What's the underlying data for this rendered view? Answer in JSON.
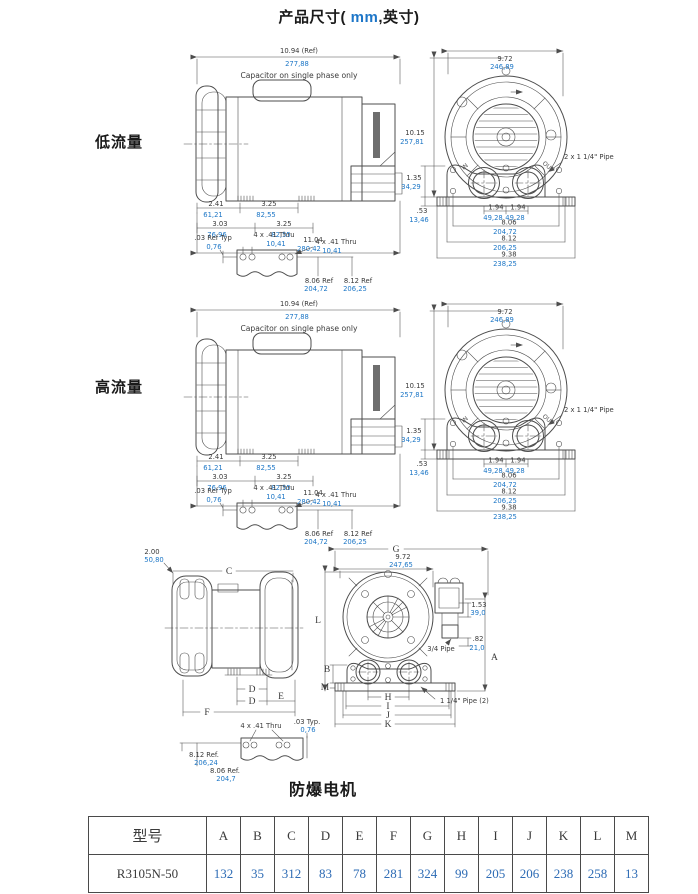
{
  "page": {
    "title_prefix": "产品尺寸(",
    "title_mm": " mm",
    "title_suffix": ",英寸)"
  },
  "sections": {
    "low_flow": "低流量",
    "high_flow": "高流量",
    "explosion_proof_motor": "防爆电机"
  },
  "colors": {
    "metric_blue": "#1c76c6",
    "ink": "#3a3a3a",
    "table_value_blue": "#2e6cb5"
  },
  "side_view": {
    "note": "Capacitor on single phase only",
    "overall_in": "10.94 (Ref)",
    "overall_mm": "277,88",
    "dim_a_in": "2.41",
    "dim_a_mm": "61,21",
    "dim_b_in": "3.25",
    "dim_b_mm": "82,55",
    "dim_c_in": "3.03",
    "dim_c_mm": "76,96",
    "dim_d_in": "3.25",
    "dim_d_mm": "82,55",
    "dim_e_in": "11.04",
    "dim_e_mm": "280,42"
  },
  "foot_detail": {
    "ref_typ_in": ".03 Ref Typ",
    "ref_typ_mm": "0,76",
    "holes1_in": "4 x .41 Thru",
    "holes1_mm": "10,41",
    "holes2_in": "4 x .41 Thru",
    "holes2_mm": "10,41",
    "ref1_in": "8.06 Ref",
    "ref1_mm": "204,72",
    "ref2_in": "8.12 Ref",
    "ref2_mm": "206,25"
  },
  "front_view": {
    "width_in": "9.72",
    "width_mm": "246,89",
    "height_in": "10.15",
    "height_mm": "257,81",
    "base_h1_in": "1.35",
    "base_h1_mm": "34,29",
    "base_h2_in": ".53",
    "base_h2_mm": "13,46",
    "pipes_label": "2 x 1 1/4\" Pipe",
    "port1_in": "1.94",
    "port1_mm": "49,28",
    "port2_in": "1.94",
    "port2_mm": "49,28",
    "bolt_w1_in": "8.06",
    "bolt_w1_mm": "204,72",
    "bolt_w2_in": "8.12",
    "bolt_w2_mm": "206,25",
    "base_w_in": "9.38",
    "base_w_mm": "238,25",
    "in_label": "IN",
    "out_label": "OUT"
  },
  "letter_side": {
    "dim_in": "2.00",
    "dim_mm": "50,80",
    "c": "C",
    "d1": "D",
    "d2": "D",
    "e": "E",
    "f": "F"
  },
  "letter_front": {
    "g": "G",
    "width_in": "9.72",
    "width_mm": "247,65",
    "l": "L",
    "b": "B",
    "m": "M",
    "a": "A",
    "h": "H",
    "i": "I",
    "j": "J",
    "k": "K",
    "box_in": "1.53",
    "box_mm": "39,0",
    "pipe_small": "3/4 Pipe",
    "offset_in": ".82",
    "offset_mm": "21,0",
    "pipes_label": "1 1/4\" Pipe (2)"
  },
  "letter_foot": {
    "holes_in": "4 x .41 Thru",
    "typ_in": ".03 Typ.",
    "typ_mm": "0,76",
    "ref1_in": "8.12 Ref.",
    "ref1_mm": "206,24",
    "ref2_in": "8.06 Ref.",
    "ref2_mm": "204,7"
  },
  "table": {
    "headers": [
      "型号",
      "A",
      "B",
      "C",
      "D",
      "E",
      "F",
      "G",
      "H",
      "I",
      "J",
      "K",
      "L",
      "M"
    ],
    "rows": [
      [
        "R3105N-50",
        "132",
        "35",
        "312",
        "83",
        "78",
        "281",
        "324",
        "99",
        "205",
        "206",
        "238",
        "258",
        "13"
      ]
    ]
  }
}
